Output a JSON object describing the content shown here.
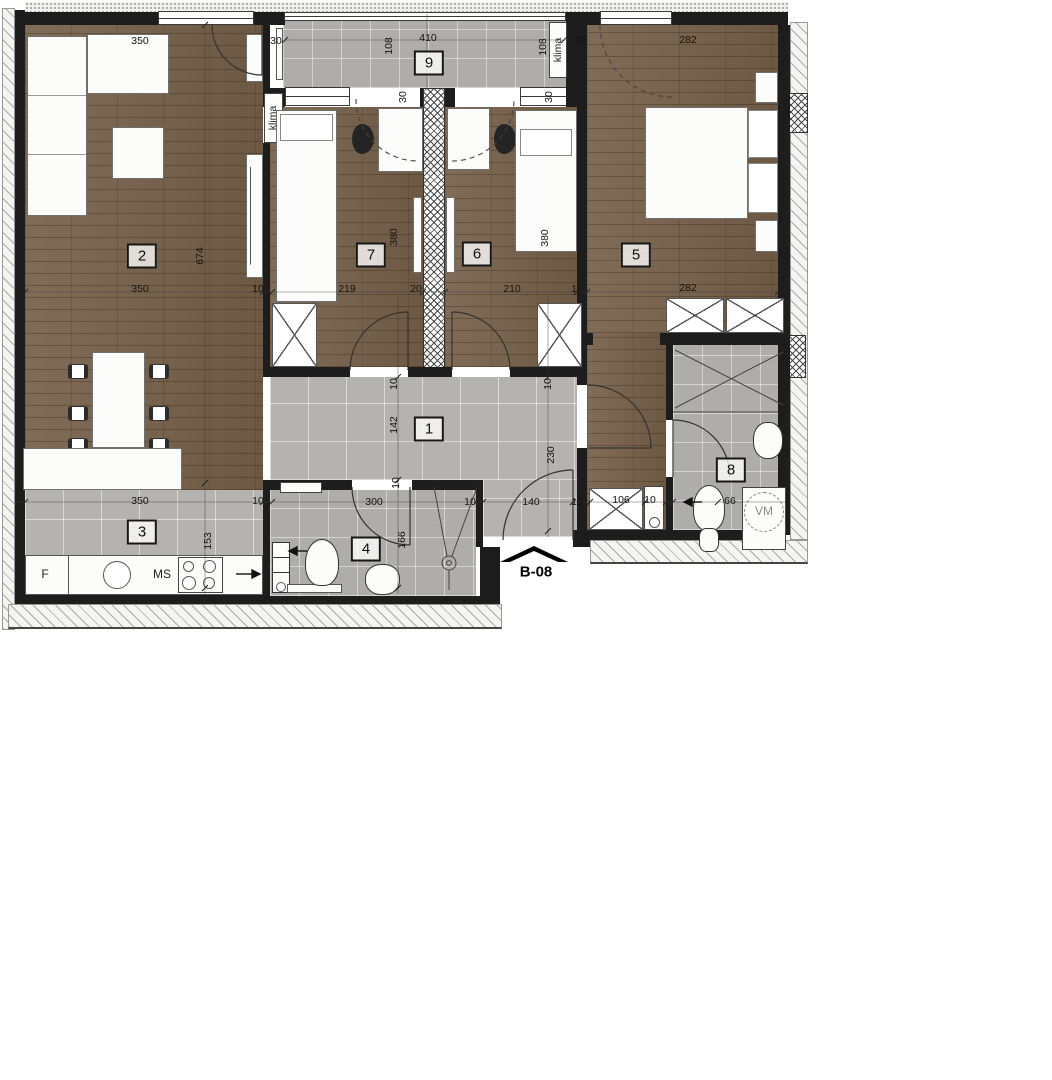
{
  "unit": {
    "code": "B-08"
  },
  "colors": {
    "wall": "#1d1d1d",
    "wood_floor": "#77614a",
    "tile_floor": "#b4b3af",
    "label_ink": "#141414"
  },
  "rooms": [
    {
      "n": "1",
      "x": 429,
      "y": 429
    },
    {
      "n": "2",
      "x": 142,
      "y": 256
    },
    {
      "n": "3",
      "x": 142,
      "y": 532
    },
    {
      "n": "4",
      "x": 366,
      "y": 549
    },
    {
      "n": "5",
      "x": 636,
      "y": 255
    },
    {
      "n": "6",
      "x": 477,
      "y": 254
    },
    {
      "n": "7",
      "x": 371,
      "y": 255
    },
    {
      "n": "8",
      "x": 731,
      "y": 470
    },
    {
      "n": "9",
      "x": 429,
      "y": 63
    }
  ],
  "dimensions": [
    {
      "t": "350",
      "x": 140,
      "y": 41,
      "v": false
    },
    {
      "t": "30",
      "x": 276,
      "y": 41,
      "v": false
    },
    {
      "t": "108",
      "x": 389,
      "y": 46,
      "v": true
    },
    {
      "t": "410",
      "x": 428,
      "y": 38,
      "v": false
    },
    {
      "t": "108",
      "x": 543,
      "y": 47,
      "v": true
    },
    {
      "t": "30",
      "x": 581,
      "y": 41,
      "v": false
    },
    {
      "t": "282",
      "x": 688,
      "y": 40,
      "v": false
    },
    {
      "t": "30",
      "x": 403,
      "y": 97,
      "v": true
    },
    {
      "t": "30",
      "x": 549,
      "y": 97,
      "v": true
    },
    {
      "t": "674",
      "x": 200,
      "y": 256,
      "v": true
    },
    {
      "t": "380",
      "x": 394,
      "y": 237,
      "v": true
    },
    {
      "t": "380",
      "x": 545,
      "y": 238,
      "v": true
    },
    {
      "t": "350",
      "x": 140,
      "y": 289,
      "v": false
    },
    {
      "t": "10",
      "x": 258,
      "y": 289,
      "v": false
    },
    {
      "t": "219",
      "x": 347,
      "y": 289,
      "v": false
    },
    {
      "t": "20",
      "x": 416,
      "y": 289,
      "v": false
    },
    {
      "t": "210",
      "x": 512,
      "y": 289,
      "v": false
    },
    {
      "t": "10",
      "x": 577,
      "y": 289,
      "v": false
    },
    {
      "t": "282",
      "x": 688,
      "y": 288,
      "v": false
    },
    {
      "t": "10",
      "x": 394,
      "y": 384,
      "v": true
    },
    {
      "t": "10",
      "x": 548,
      "y": 384,
      "v": true
    },
    {
      "t": "142",
      "x": 394,
      "y": 425,
      "v": true
    },
    {
      "t": "230",
      "x": 551,
      "y": 455,
      "v": true
    },
    {
      "t": "350",
      "x": 140,
      "y": 501,
      "v": false
    },
    {
      "t": "10",
      "x": 258,
      "y": 501,
      "v": false
    },
    {
      "t": "300",
      "x": 374,
      "y": 502,
      "v": false
    },
    {
      "t": "10",
      "x": 470,
      "y": 502,
      "v": false
    },
    {
      "t": "140",
      "x": 531,
      "y": 502,
      "v": false
    },
    {
      "t": "10",
      "x": 577,
      "y": 502,
      "v": false
    },
    {
      "t": "106",
      "x": 621,
      "y": 500,
      "v": false
    },
    {
      "t": "10",
      "x": 650,
      "y": 500,
      "v": false
    },
    {
      "t": "66",
      "x": 730,
      "y": 501,
      "v": false
    },
    {
      "t": "153",
      "x": 208,
      "y": 541,
      "v": true
    },
    {
      "t": "10",
      "x": 396,
      "y": 483,
      "v": true
    },
    {
      "t": "166",
      "x": 402,
      "y": 540,
      "v": true
    }
  ],
  "annotations": [
    {
      "t": "klima",
      "x": 273,
      "y": 118,
      "v": true,
      "gray": false
    },
    {
      "t": "klima",
      "x": 558,
      "y": 50,
      "v": true,
      "gray": false
    },
    {
      "t": "F",
      "x": 45,
      "y": 574,
      "v": false,
      "gray": false
    },
    {
      "t": "MS",
      "x": 162,
      "y": 574,
      "v": false,
      "gray": false
    },
    {
      "t": "VM",
      "x": 764,
      "y": 511,
      "v": false,
      "gray": true
    }
  ]
}
